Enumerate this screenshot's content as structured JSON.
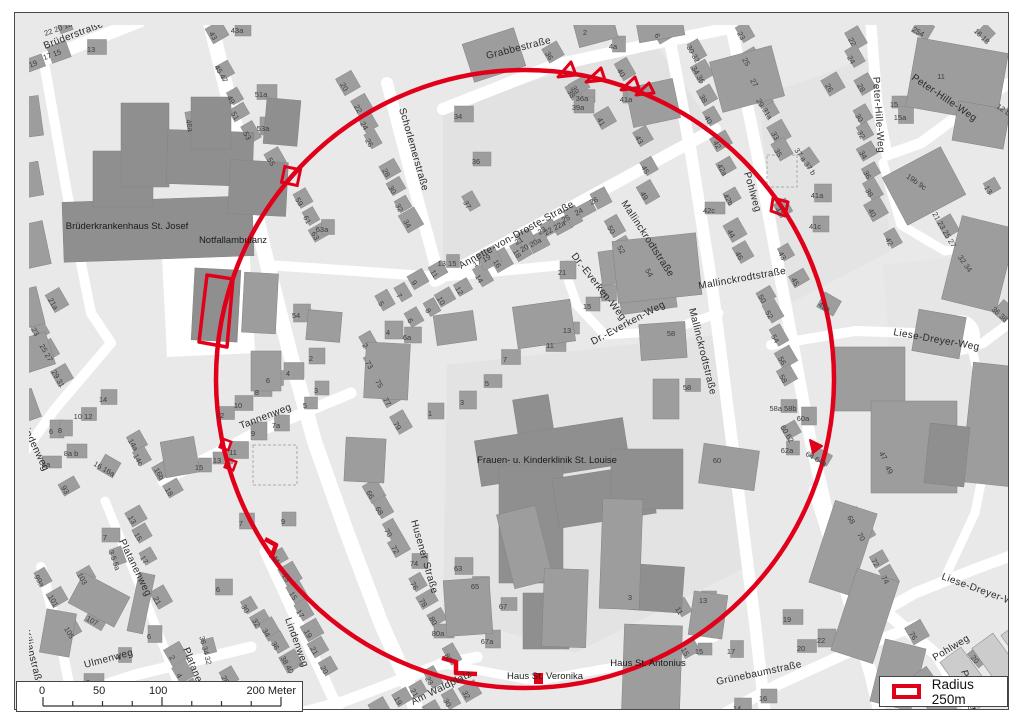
{
  "legend": {
    "label": "Radius 250m"
  },
  "scale_bar": {
    "labels": [
      "0",
      "50",
      "100",
      "200 Meter"
    ]
  },
  "colors": {
    "radius_red": "#e10019",
    "building_mid": "#9d9d9d",
    "building_dark": "#8f8f8f",
    "building_light": "#cccccc",
    "street_white": "#ffffff",
    "block_gray": "#e9e9e9",
    "label_text": "#2b2b2b"
  },
  "map": {
    "street_labels": [
      [
        "Brüderstraße",
        30,
        36,
        -21
      ],
      [
        "Grabbestraße",
        472,
        46,
        -14
      ],
      [
        "Schorlemerstraße",
        384,
        96,
        74
      ],
      [
        "Annette-von-Droste-Straße",
        446,
        256,
        -29
      ],
      [
        "Mallinckrodtstraße",
        606,
        190,
        57
      ],
      [
        "Mallinckrodtstraße",
        684,
        276,
        -10
      ],
      [
        "Mallinckrodtstraße",
        674,
        296,
        76
      ],
      [
        "Pohlweg",
        729,
        160,
        74
      ],
      [
        "Peter-Hille-Weg",
        858,
        64,
        86
      ],
      [
        "Peter-Hille-Weg",
        896,
        66,
        34
      ],
      [
        "Liese-Dreyer-Weg",
        878,
        322,
        10
      ],
      [
        "Liese-Dreyer-Weg",
        926,
        566,
        20
      ],
      [
        "Dr.-Everken-Weg",
        556,
        243,
        52
      ],
      [
        "Dr.-Everken-Weg",
        578,
        332,
        -28
      ],
      [
        "Husener Straße",
        396,
        508,
        74
      ],
      [
        "Tannenweg",
        226,
        416,
        -21
      ],
      [
        "Lindenweg",
        6,
        412,
        64
      ],
      [
        "Lindenweg",
        270,
        606,
        70
      ],
      [
        "Ulmenweg",
        70,
        655,
        -15
      ],
      [
        "Kilianstraße",
        8,
        618,
        76
      ],
      [
        "Platanenweg",
        104,
        528,
        64
      ],
      [
        "Platanenweg",
        168,
        636,
        68
      ],
      [
        "Am Waldplatz",
        398,
        692,
        -26
      ],
      [
        "Grünebaumstraße",
        702,
        672,
        -12
      ],
      [
        "Pohlweg",
        920,
        648,
        -31
      ],
      [
        "Pohlweg",
        946,
        658,
        76
      ]
    ],
    "place_labels": [
      [
        "Brüderkrankenhaus St. Josef",
        112,
        216
      ],
      [
        "Notfallambulanz",
        218,
        230
      ],
      [
        "Frauen- u. Kinderklinik  St. Louise",
        532,
        450
      ],
      [
        "Haus St. Veronika",
        530,
        666
      ],
      [
        "Haus St. Antonius",
        633,
        653
      ]
    ],
    "house_numbers": [
      [
        "22 20 18",
        44,
        18,
        -20
      ],
      [
        "17 15",
        38,
        44,
        -20
      ],
      [
        "13",
        76,
        39,
        0
      ],
      [
        "21 19",
        14,
        55,
        -20
      ],
      [
        "43",
        196,
        24,
        60
      ],
      [
        "43a",
        222,
        20,
        0
      ],
      [
        "45 47",
        204,
        62,
        60
      ],
      [
        "49",
        214,
        88,
        60
      ],
      [
        "51",
        218,
        104,
        60
      ],
      [
        "51a",
        246,
        84,
        0
      ],
      [
        "53",
        230,
        124,
        60
      ],
      [
        "53a",
        248,
        118,
        0
      ],
      [
        "55",
        254,
        150,
        60
      ],
      [
        "59",
        282,
        190,
        60
      ],
      [
        "61",
        290,
        208,
        60
      ],
      [
        "63",
        298,
        224,
        60
      ],
      [
        "63a",
        307,
        219,
        0
      ],
      [
        "46a",
        172,
        113,
        80
      ],
      [
        "20",
        327,
        75,
        60
      ],
      [
        "22",
        341,
        97,
        60
      ],
      [
        "24",
        347,
        114,
        60
      ],
      [
        "26",
        352,
        131,
        60
      ],
      [
        "28",
        369,
        161,
        60
      ],
      [
        "30",
        375,
        178,
        60
      ],
      [
        "32",
        382,
        196,
        60
      ],
      [
        "34",
        390,
        212,
        60
      ],
      [
        "34",
        443,
        106,
        0
      ],
      [
        "36",
        461,
        151,
        0
      ],
      [
        "37",
        450,
        193,
        60
      ],
      [
        "36",
        532,
        44,
        60
      ],
      [
        "38",
        554,
        82,
        60
      ],
      [
        "36a",
        567,
        88,
        0
      ],
      [
        "39",
        558,
        78,
        60
      ],
      [
        "39a",
        563,
        97,
        0
      ],
      [
        "40",
        604,
        61,
        60
      ],
      [
        "41a",
        611,
        89,
        0
      ],
      [
        "41",
        584,
        110,
        60
      ],
      [
        "43",
        622,
        128,
        60
      ],
      [
        "45",
        628,
        158,
        60
      ],
      [
        "2",
        570,
        22,
        0
      ],
      [
        "4a",
        598,
        36,
        0
      ],
      [
        "6",
        640,
        24,
        60
      ],
      [
        "30 32",
        676,
        42,
        60
      ],
      [
        "34 36",
        681,
        63,
        60
      ],
      [
        "38",
        686,
        87,
        60
      ],
      [
        "40",
        691,
        108,
        60
      ],
      [
        "42",
        700,
        133,
        60
      ],
      [
        "42a",
        705,
        158,
        60
      ],
      [
        "42b",
        711,
        188,
        60
      ],
      [
        "42c",
        694,
        200,
        0
      ],
      [
        "44",
        714,
        222,
        60
      ],
      [
        "46",
        722,
        244,
        60
      ],
      [
        "23",
        724,
        24,
        60
      ],
      [
        "25",
        729,
        50,
        60
      ],
      [
        "27",
        737,
        71,
        60
      ],
      [
        "29",
        743,
        91,
        60
      ],
      [
        "31a",
        750,
        102,
        60
      ],
      [
        "33",
        758,
        124,
        60
      ],
      [
        "35",
        761,
        141,
        60
      ],
      [
        "37 a 37 b",
        788,
        150,
        55
      ],
      [
        "41a",
        802,
        185,
        0
      ],
      [
        "41c",
        800,
        216,
        0
      ],
      [
        "41",
        762,
        200,
        60
      ],
      [
        "43",
        765,
        244,
        60
      ],
      [
        "45",
        778,
        270,
        60
      ],
      [
        "22",
        835,
        30,
        60
      ],
      [
        "24",
        834,
        48,
        60
      ],
      [
        "26",
        812,
        76,
        60
      ],
      [
        "28",
        844,
        76,
        60
      ],
      [
        "30",
        842,
        106,
        60
      ],
      [
        "32",
        844,
        123,
        60
      ],
      [
        "34",
        846,
        143,
        60
      ],
      [
        "36",
        850,
        163,
        60
      ],
      [
        "38",
        852,
        181,
        60
      ],
      [
        "40",
        855,
        201,
        60
      ],
      [
        "254",
        902,
        21,
        30
      ],
      [
        "11",
        926,
        66,
        0
      ],
      [
        "15",
        879,
        94,
        0
      ],
      [
        "15a",
        885,
        107,
        0
      ],
      [
        "12 b 14a",
        993,
        103,
        35
      ],
      [
        "13",
        971,
        178,
        60
      ],
      [
        "19b 9c",
        900,
        171,
        35
      ],
      [
        "21 23 25 27",
        927,
        218,
        60
      ],
      [
        "32 34",
        948,
        252,
        55
      ],
      [
        "42",
        872,
        230,
        60
      ],
      [
        "36 38",
        983,
        303,
        42
      ],
      [
        "26 a",
        1004,
        261,
        40
      ],
      [
        "16 18",
        965,
        25,
        45
      ],
      [
        "20",
        1003,
        78,
        60
      ],
      [
        "49",
        627,
        184,
        60
      ],
      [
        "50",
        594,
        218,
        60
      ],
      [
        "52",
        604,
        238,
        60
      ],
      [
        "54",
        632,
        261,
        60
      ],
      [
        "58",
        656,
        323,
        0
      ],
      [
        "58",
        672,
        377,
        0
      ],
      [
        "60",
        702,
        450,
        0
      ],
      [
        "50",
        745,
        287,
        60
      ],
      [
        "52",
        752,
        303,
        60
      ],
      [
        "54",
        758,
        327,
        60
      ],
      [
        "56",
        765,
        349,
        60
      ],
      [
        "58",
        766,
        367,
        60
      ],
      [
        "58a 58b",
        768,
        398,
        0
      ],
      [
        "60a",
        788,
        408,
        0
      ],
      [
        "60 62",
        770,
        422,
        60
      ],
      [
        "62a",
        772,
        440,
        0
      ],
      [
        "64 64a",
        800,
        448,
        30
      ],
      [
        "45a",
        808,
        296,
        30
      ],
      [
        "47",
        866,
        444,
        60
      ],
      [
        "49",
        872,
        458,
        60
      ],
      [
        "21",
        547,
        262,
        0
      ],
      [
        "17",
        588,
        285,
        0
      ],
      [
        "15",
        572,
        296,
        0
      ],
      [
        "13",
        552,
        320,
        0
      ],
      [
        "11",
        535,
        335,
        0
      ],
      [
        "7",
        490,
        349,
        0
      ],
      [
        "5",
        472,
        373,
        0
      ],
      [
        "3",
        447,
        392,
        0
      ],
      [
        "1",
        415,
        403,
        0
      ],
      [
        "73",
        352,
        353,
        60
      ],
      [
        "75",
        362,
        372,
        60
      ],
      [
        "77",
        370,
        390,
        60
      ],
      [
        "79",
        380,
        414,
        60
      ],
      [
        "2",
        348,
        334,
        60
      ],
      [
        "4",
        373,
        322,
        0
      ],
      [
        "6a",
        392,
        327,
        0
      ],
      [
        "6",
        393,
        309,
        60
      ],
      [
        "8",
        411,
        299,
        60
      ],
      [
        "10",
        424,
        289,
        60
      ],
      [
        "12",
        442,
        279,
        60
      ],
      [
        "14",
        462,
        267,
        60
      ],
      [
        "16",
        480,
        252,
        60
      ],
      [
        "18",
        500,
        242,
        60
      ],
      [
        "5",
        364,
        292,
        60
      ],
      [
        "7",
        382,
        284,
        60
      ],
      [
        "9",
        397,
        271,
        60
      ],
      [
        "11",
        417,
        262,
        60
      ],
      [
        "13 15",
        432,
        253,
        0
      ],
      [
        "17 19",
        468,
        250,
        -28
      ],
      [
        "20 20a",
        517,
        234,
        -28
      ],
      [
        "22 22a",
        541,
        217,
        -28
      ],
      [
        "24",
        565,
        201,
        -28
      ],
      [
        "26",
        580,
        190,
        -28
      ],
      [
        "21",
        505,
        230,
        -28
      ],
      [
        "23",
        528,
        220,
        -28
      ],
      [
        "25",
        552,
        208,
        -28
      ],
      [
        "66",
        353,
        483,
        60
      ],
      [
        "68",
        362,
        499,
        60
      ],
      [
        "70",
        371,
        521,
        60
      ],
      [
        "72",
        378,
        538,
        60
      ],
      [
        "74",
        399,
        553,
        0
      ],
      [
        "76",
        397,
        574,
        60
      ],
      [
        "78",
        406,
        591,
        60
      ],
      [
        "80",
        416,
        609,
        60
      ],
      [
        "80a",
        423,
        623,
        0
      ],
      [
        "82",
        431,
        646,
        60
      ],
      [
        "63",
        443,
        558,
        0
      ],
      [
        "65",
        460,
        576,
        0
      ],
      [
        "67",
        488,
        596,
        0
      ],
      [
        "67a",
        472,
        631,
        0
      ],
      [
        "19",
        381,
        689,
        60
      ],
      [
        "21",
        397,
        681,
        60
      ],
      [
        "23",
        412,
        669,
        60
      ],
      [
        "17",
        359,
        701,
        60
      ],
      [
        "28",
        412,
        703,
        60
      ],
      [
        "30",
        430,
        691,
        60
      ],
      [
        "32",
        449,
        683,
        60
      ],
      [
        "7",
        226,
        513,
        0
      ],
      [
        "9",
        268,
        511,
        0
      ],
      [
        "11",
        259,
        548,
        60
      ],
      [
        "13",
        269,
        566,
        60
      ],
      [
        "15",
        276,
        584,
        60
      ],
      [
        "17",
        283,
        602,
        60
      ],
      [
        "19",
        291,
        622,
        60
      ],
      [
        "21",
        297,
        639,
        60
      ],
      [
        "20",
        307,
        658,
        60
      ],
      [
        "30",
        228,
        597,
        60
      ],
      [
        "32",
        239,
        611,
        60
      ],
      [
        "34",
        249,
        621,
        60
      ],
      [
        "36",
        258,
        634,
        60
      ],
      [
        "38 40",
        270,
        653,
        60
      ],
      [
        "6",
        203,
        579,
        0
      ],
      [
        "28",
        208,
        668,
        60
      ],
      [
        "36 34 32",
        188,
        638,
        75
      ],
      [
        "6",
        134,
        626,
        0
      ],
      [
        "4",
        104,
        647,
        0
      ],
      [
        "2",
        73,
        672,
        0
      ],
      [
        "2",
        155,
        646,
        60
      ],
      [
        "4",
        162,
        664,
        60
      ],
      [
        "6",
        170,
        681,
        60
      ],
      [
        "99a",
        22,
        569,
        60
      ],
      [
        "101",
        36,
        589,
        60
      ],
      [
        "103",
        65,
        567,
        60
      ],
      [
        "105",
        52,
        621,
        60
      ],
      [
        "107",
        76,
        610,
        30
      ],
      [
        "21",
        140,
        589,
        60
      ],
      [
        "7",
        90,
        527,
        0
      ],
      [
        "3 5 5a",
        97,
        548,
        70
      ],
      [
        "13",
        115,
        508,
        60
      ],
      [
        "15",
        121,
        525,
        60
      ],
      [
        "17",
        127,
        548,
        60
      ],
      [
        "93",
        48,
        478,
        60
      ],
      [
        "21a",
        36,
        292,
        60
      ],
      [
        "23",
        18,
        320,
        60
      ],
      [
        "25 27",
        29,
        341,
        60
      ],
      [
        "29 31",
        41,
        367,
        60
      ],
      [
        "14",
        88,
        389,
        0
      ],
      [
        "10 12",
        68,
        406,
        0
      ],
      [
        "6",
        36,
        421,
        0
      ],
      [
        "8",
        45,
        420,
        0
      ],
      [
        "8a b",
        56,
        443,
        0
      ],
      [
        "4a",
        31,
        454,
        0
      ],
      [
        "16 16a",
        88,
        458,
        30
      ],
      [
        "14a",
        116,
        433,
        60
      ],
      [
        "14c",
        121,
        448,
        60
      ],
      [
        "16b",
        142,
        462,
        60
      ],
      [
        "18",
        152,
        480,
        60
      ],
      [
        "15",
        184,
        457,
        0
      ],
      [
        "13",
        202,
        450,
        0
      ],
      [
        "11",
        218,
        442,
        0
      ],
      [
        "10",
        223,
        395,
        0
      ],
      [
        "12",
        205,
        405,
        0
      ],
      [
        "9",
        238,
        423,
        0
      ],
      [
        "7a",
        261,
        415,
        0
      ],
      [
        "3",
        301,
        380,
        0
      ],
      [
        "5",
        290,
        395,
        0
      ],
      [
        "4",
        273,
        363,
        0
      ],
      [
        "6",
        253,
        370,
        0
      ],
      [
        "8",
        242,
        382,
        0
      ],
      [
        "54",
        281,
        305,
        0
      ],
      [
        "2",
        296,
        348,
        0
      ],
      [
        "13",
        688,
        590,
        0
      ],
      [
        "15",
        684,
        641,
        0
      ],
      [
        "17",
        716,
        641,
        0
      ],
      [
        "19",
        772,
        609,
        0
      ],
      [
        "20",
        786,
        638,
        0
      ],
      [
        "22",
        806,
        630,
        0
      ],
      [
        "14",
        722,
        698,
        0
      ],
      [
        "16",
        748,
        688,
        0
      ],
      [
        "68",
        834,
        508,
        60
      ],
      [
        "70",
        844,
        525,
        60
      ],
      [
        "72",
        858,
        551,
        60
      ],
      [
        "74",
        868,
        568,
        60
      ],
      [
        "76",
        896,
        624,
        60
      ],
      [
        "20",
        958,
        648,
        50
      ],
      [
        "3",
        615,
        587,
        0
      ],
      [
        "11",
        662,
        599,
        60
      ],
      [
        "15",
        668,
        640,
        60
      ]
    ]
  }
}
